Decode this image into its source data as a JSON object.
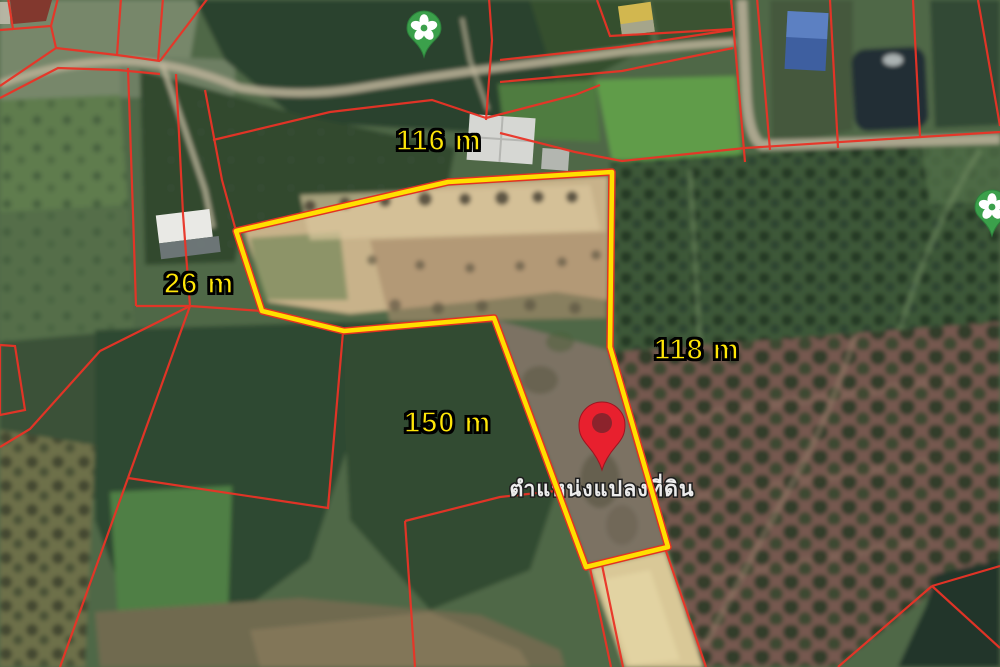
{
  "map": {
    "type": "satellite-land-plot-map",
    "dimension_labels": [
      {
        "id": "top-side",
        "text": "116 m"
      },
      {
        "id": "left-side",
        "text": "26 m"
      },
      {
        "id": "center-side",
        "text": "150 m"
      },
      {
        "id": "right-side",
        "text": "118 m"
      }
    ],
    "plot_marker": {
      "icon": "red-location-pin",
      "label": "ตำแหน่งแปลงที่ดิน"
    },
    "poi_markers": [
      {
        "icon": "green-plant-pin",
        "position": "top-center"
      },
      {
        "icon": "green-plant-pin",
        "position": "right-edge"
      }
    ],
    "colors": {
      "plot_outline_yellow": "#ffdf00",
      "cadastral_line_red": "#ea3326",
      "dimension_label_yellow": "#ffe608",
      "marker_pin_red": "#e8202e",
      "poi_pin_green": "#3ba04b",
      "marker_label_white": "#ececec"
    }
  }
}
